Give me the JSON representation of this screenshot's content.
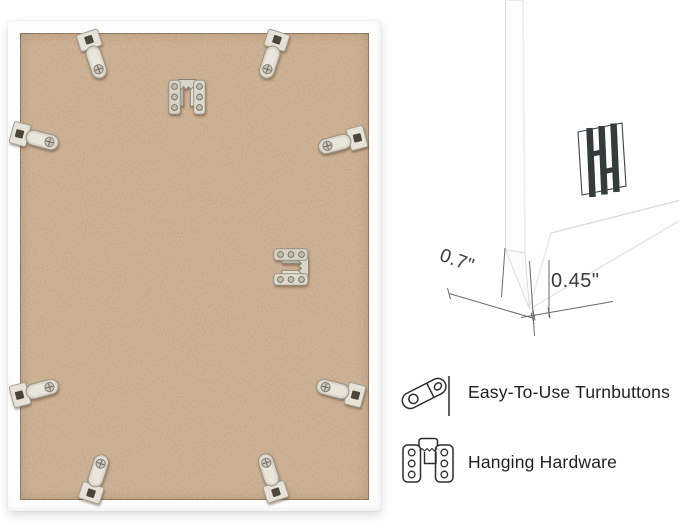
{
  "dimensions": {
    "depth": "0.7\"",
    "face": "0.45\""
  },
  "features": [
    {
      "icon": "turnbutton-icon",
      "label": "Easy-To-Use Turnbuttons"
    },
    {
      "icon": "hanging-hardware-icon",
      "label": "Hanging Hardware"
    }
  ],
  "photo": {
    "turnbutton_count": 8,
    "hanging_bracket_count": 2,
    "brand_mark": "HH monogram stamp"
  },
  "colors": {
    "background": "#ffffff",
    "frame_white": "#fdfdfd",
    "mdf_base": "#c5a687",
    "metal": "#d9d5ca",
    "annotation_line": "#6a6a6a",
    "text": "#1f1f1f"
  }
}
